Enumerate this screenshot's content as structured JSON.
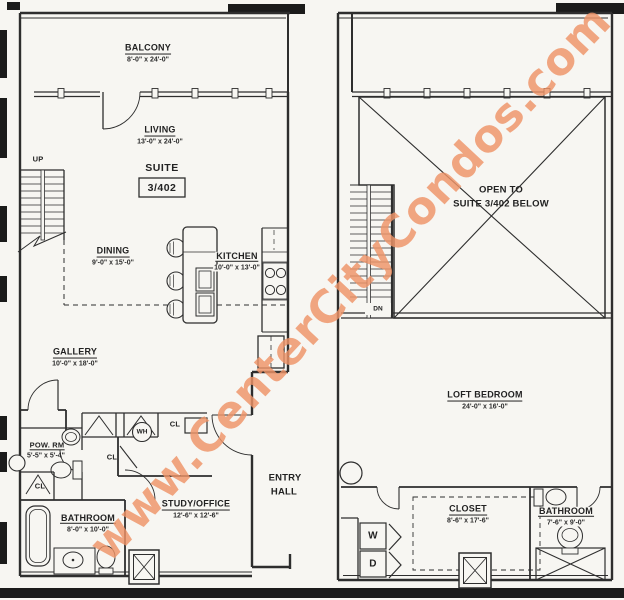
{
  "watermark": {
    "text": "www.CenterCityCondos.com",
    "color": "#ef9468"
  },
  "colors": {
    "paper": "#f7f6f2",
    "line": "#2e2e2e",
    "black_bar": "#1b1b1b"
  },
  "level1": {
    "balcony": {
      "name": "BALCONY",
      "dims": "8'-0\" x 24'-0\""
    },
    "living": {
      "name": "LIVING",
      "dims": "13'-0\" x 24'-0\""
    },
    "suite_label": "SUITE",
    "suite_number": "3/402",
    "stairs_label": "UP",
    "dining": {
      "name": "DINING",
      "dims": "9'-0\" x 15'-0\""
    },
    "kitchen": {
      "name": "KITCHEN",
      "dims": "10'-0\" x 13'-0\""
    },
    "gallery": {
      "name": "GALLERY",
      "dims": "10'-0\" x 18'-0\""
    },
    "powder_room": {
      "name": "POW. RM",
      "dims": "5'-5\" x 5'-4\""
    },
    "bathroom": {
      "name": "BATHROOM",
      "dims": "8'-0\" x 10'-0\""
    },
    "study": {
      "name": "STUDY/OFFICE",
      "dims": "12'-6\" x 12'-6\""
    },
    "closet_abbr": "CL",
    "water_heater_abbr": "WH",
    "entry_hall_line1": "ENTRY",
    "entry_hall_line2": "HALL"
  },
  "level2": {
    "open_below_line1": "OPEN TO",
    "open_below_line2": "SUITE 3/402 BELOW",
    "stairs_label": "DN",
    "loft_bedroom": {
      "name": "LOFT BEDROOM",
      "dims": "24'-0\" x 16'-0\""
    },
    "closet": {
      "name": "CLOSET",
      "dims": "8'-6\" x 17'-6\""
    },
    "bathroom": {
      "name": "BATHROOM",
      "dims": "7'-6\" x 9'-0\""
    },
    "washer_abbr": "W",
    "dryer_abbr": "D"
  }
}
